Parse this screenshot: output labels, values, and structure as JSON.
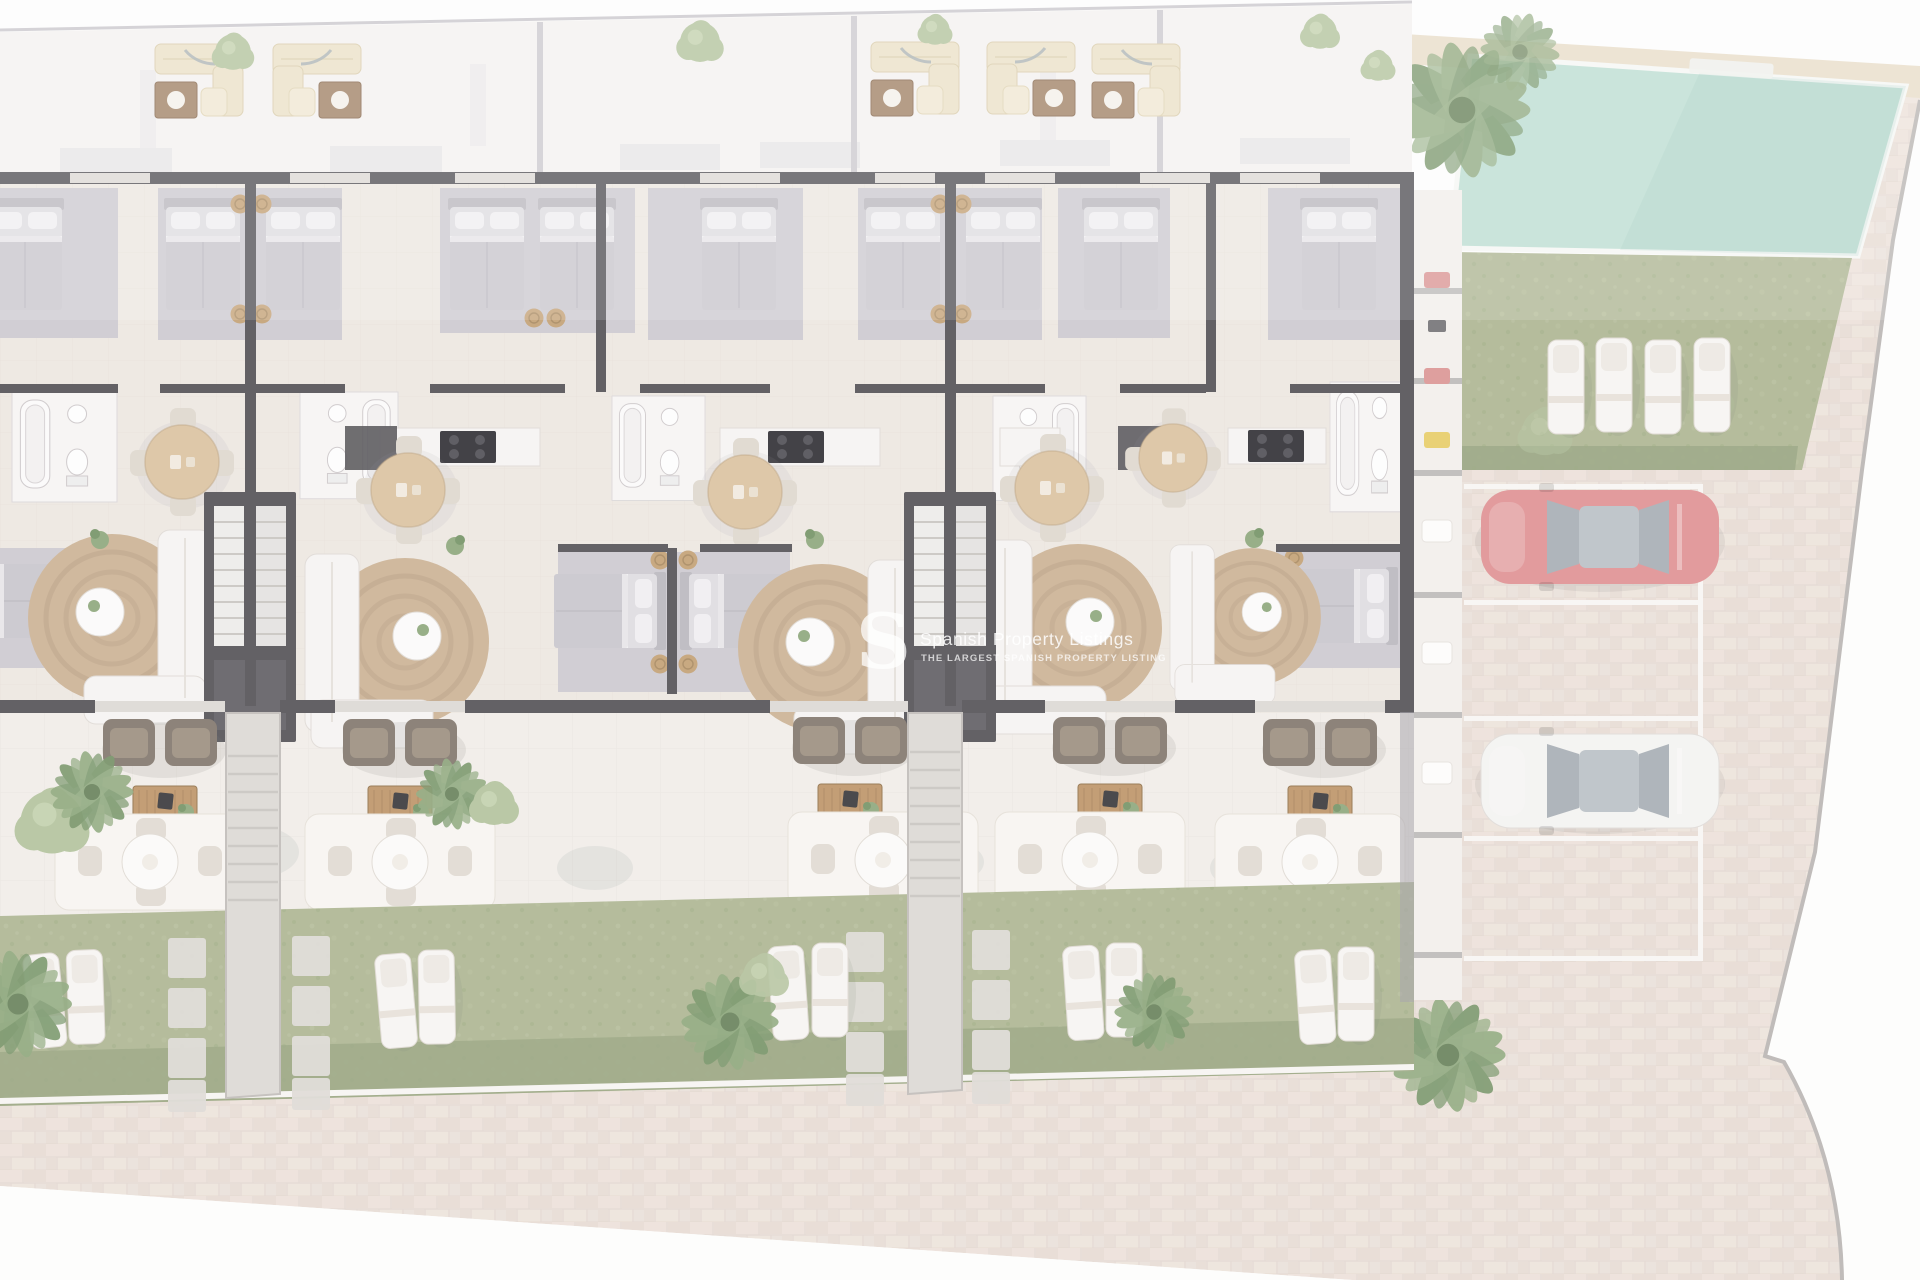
{
  "watermark": {
    "logo": "S",
    "line1": "Spanish Property Listings",
    "line2": "THE LARGEST SPANISH PROPERTY LISTING"
  },
  "palette": {
    "outside": "#fdfdfc",
    "paver": "#e8dfd8",
    "paver_line": "#d8c8bd",
    "roof": "#f3f1ef",
    "roof_divider": "#c9c6cc",
    "floor": "#ebe5df",
    "wall": "#48464b",
    "carpet": "#c9c6cd",
    "white_furniture": "#f5f3f1",
    "furn_outline": "#d8d3cf",
    "bed_base": "#dcdade",
    "bed_blanket": "#c5c2c9",
    "pillow": "#efedf0",
    "headboard": "#b6b3ba",
    "pouf": "#bf9a6c",
    "jute": "#c8ad8d",
    "jute_ring": "#b2967a",
    "wood": "#b98e5f",
    "sofa_dark": "#7a6e63",
    "sofa_dark_cushion": "#968877",
    "table_tan": "#d9bf9b",
    "chair_light": "#dcd5cb",
    "lawn": "#a8b18b",
    "lawn_dark": "#8e9c76",
    "plant": "#87a274",
    "plant_dark": "#6c8c5c",
    "plant_sage": "#aebf97",
    "pool_water": "#b7dbce",
    "pool_deck": "#e7dbc5",
    "stair": "#dad6d2",
    "step": "#c5c1bd",
    "stall_line": "#f7f5f2",
    "car_red": "#dd8a8c",
    "car_white": "#f3f2f0",
    "car_window": "#a2a9b0",
    "watermark": "rgba(255,255,255,0.82)"
  },
  "scene": {
    "units_visible": 5,
    "roof_lounge_sets": 5,
    "garden_loungers_per_unit": 2,
    "pool_lawn_loungers": 4,
    "parking_stalls": 4,
    "cars": [
      {
        "name": "red-car",
        "palette_key": "car_red"
      },
      {
        "name": "white-car",
        "palette_key": "car_white"
      }
    ]
  }
}
